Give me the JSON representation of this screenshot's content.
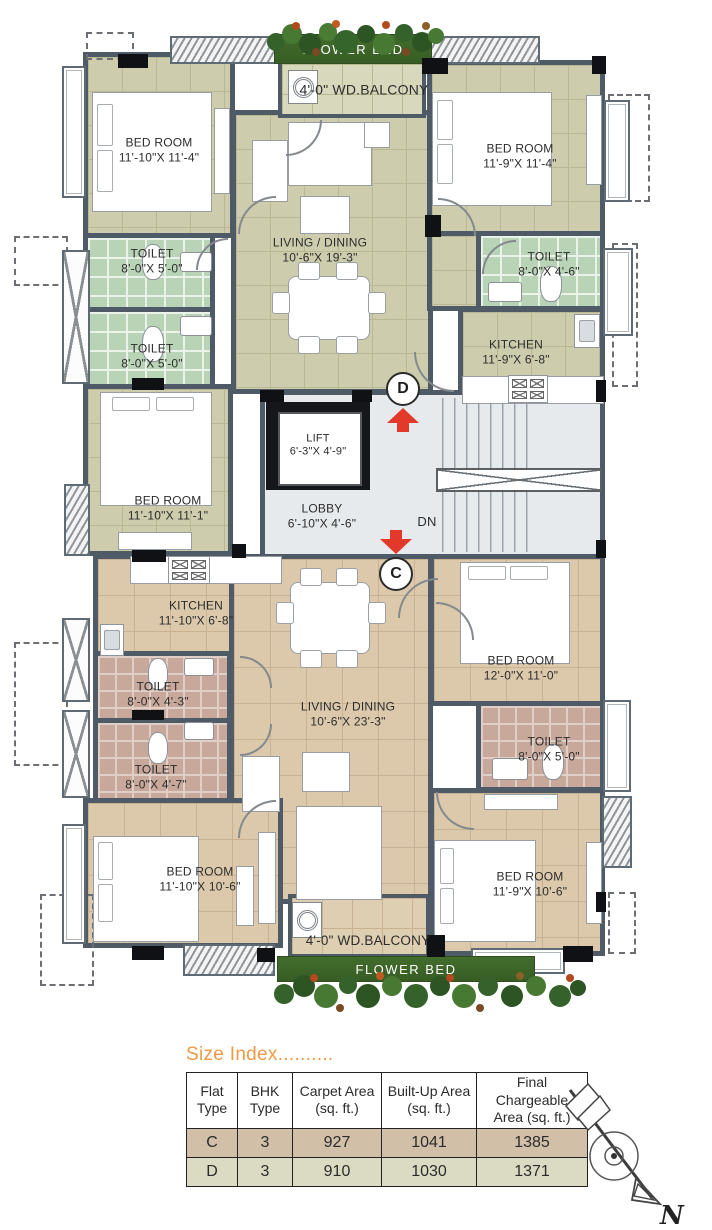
{
  "labels": {
    "flower_bed_top": "FLOWER BED",
    "flower_bed_bottom": "FLOWER BED",
    "balcony_top": "4'-0\" WD.BALCONY",
    "balcony_bottom": "4'-0\" WD.BALCONY",
    "dn": "DN",
    "flat_d_marker": "D",
    "flat_c_marker": "C",
    "north": "N"
  },
  "plan": {
    "rooms": {
      "d_bed1": {
        "name": "BED ROOM",
        "dims": "11'-10\"X 11'-4\""
      },
      "d_bed2": {
        "name": "BED ROOM",
        "dims": "11'-9\"X 11'-4\""
      },
      "d_bed3": {
        "name": "BED ROOM",
        "dims": "11'-10\"X 11'-1\""
      },
      "d_living": {
        "name": "LIVING / DINING",
        "dims": "10'-6\"X 19'-3\""
      },
      "d_toilet1": {
        "name": "TOILET",
        "dims": "8'-0\"X 5'-0\""
      },
      "d_toilet2": {
        "name": "TOILET",
        "dims": "8'-0\"X 5'-0\""
      },
      "d_toilet3": {
        "name": "TOILET",
        "dims": "8'-0\"X 4'-6\""
      },
      "d_kitchen": {
        "name": "KITCHEN",
        "dims": "11'-9\"X 6'-8\""
      },
      "lift": {
        "name": "LIFT",
        "dims": "6'-3\"X 4'-9\""
      },
      "lobby": {
        "name": "LOBBY",
        "dims": "6'-10\"X 4'-6\""
      },
      "c_kitchen": {
        "name": "KITCHEN",
        "dims": "11'-10\"X 6'-8\""
      },
      "c_toilet1": {
        "name": "TOILET",
        "dims": "8'-0\"X 4'-3\""
      },
      "c_toilet2": {
        "name": "TOILET",
        "dims": "8'-0\"X 4'-7\""
      },
      "c_living": {
        "name": "LIVING / DINING",
        "dims": "10'-6\"X 23'-3\""
      },
      "c_bed1": {
        "name": "BED ROOM",
        "dims": "12'-0\"X 11'-0\""
      },
      "c_toilet3": {
        "name": "TOILET",
        "dims": "8'-0\"X 5'-0\""
      },
      "c_bed2": {
        "name": "BED ROOM",
        "dims": "11'-10\"X 10'-6\""
      },
      "c_bed3": {
        "name": "BED ROOM",
        "dims": "11'-9\"X 10'-6\""
      }
    }
  },
  "size_index": {
    "title": "Size Index..........",
    "headers": [
      {
        "l1": "Flat",
        "l2": "Type"
      },
      {
        "l1": "BHK",
        "l2": "Type"
      },
      {
        "l1": "Carpet Area",
        "l2": "(sq. ft.)"
      },
      {
        "l1": "Built-Up Area",
        "l2": "(sq. ft.)"
      },
      {
        "l1": "Final Chargeable",
        "l2": "Area (sq. ft.)"
      }
    ],
    "rows": [
      [
        "C",
        "3",
        "927",
        "1041",
        "1385"
      ],
      [
        "D",
        "3",
        "910",
        "1030",
        "1371"
      ]
    ]
  },
  "colors": {
    "wall": "#4e5a66",
    "floorD": "#cdcdae",
    "floorDline": "#b8b893",
    "floorC": "#dcc9ab",
    "floorCline": "#c9b292",
    "tileG": "#b9d3b6",
    "tileGline": "#e9f3e8",
    "tileP": "#c8a89a",
    "tilePline": "#e0cfc7",
    "core": "#e7eaec",
    "balconyD": "#d8d8bd",
    "balconyC": "#dfcfb2",
    "red": "#e2392b",
    "green": "#426d2c",
    "orange": "#ec9a45",
    "rowC": "#d2bfa8",
    "rowD": "#dbdbc4"
  }
}
